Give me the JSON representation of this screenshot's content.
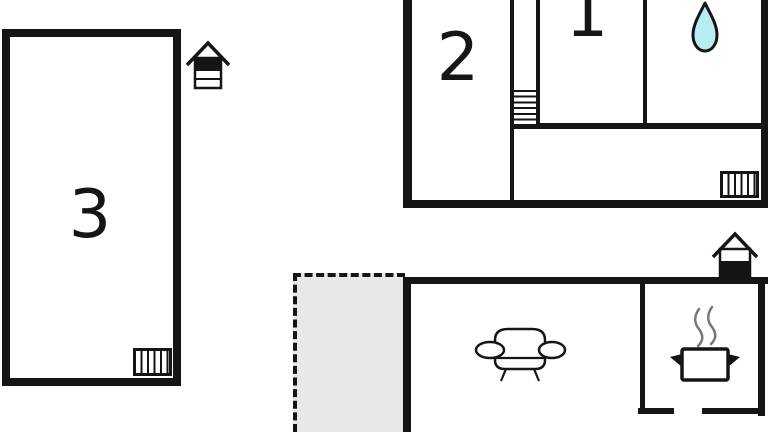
{
  "labels": {
    "room1": "1",
    "room2": "2",
    "room3": "3"
  },
  "colors": {
    "wall": "#151515",
    "background": "#ffffff",
    "water_drop_fill": "#b7edf1",
    "terrace_fill": "#e8e8e8",
    "steam": "#777777"
  },
  "icons": {
    "water_drop": "bathroom-water-drop",
    "sofa": "living-room-sofa",
    "cooking_pot": "kitchen-cooking-pot",
    "stairs": "staircase",
    "radiator_upper": "radiator",
    "radiator_annex": "radiator",
    "house_upper": "floor-indicator-upper",
    "house_ground": "floor-indicator-ground"
  }
}
